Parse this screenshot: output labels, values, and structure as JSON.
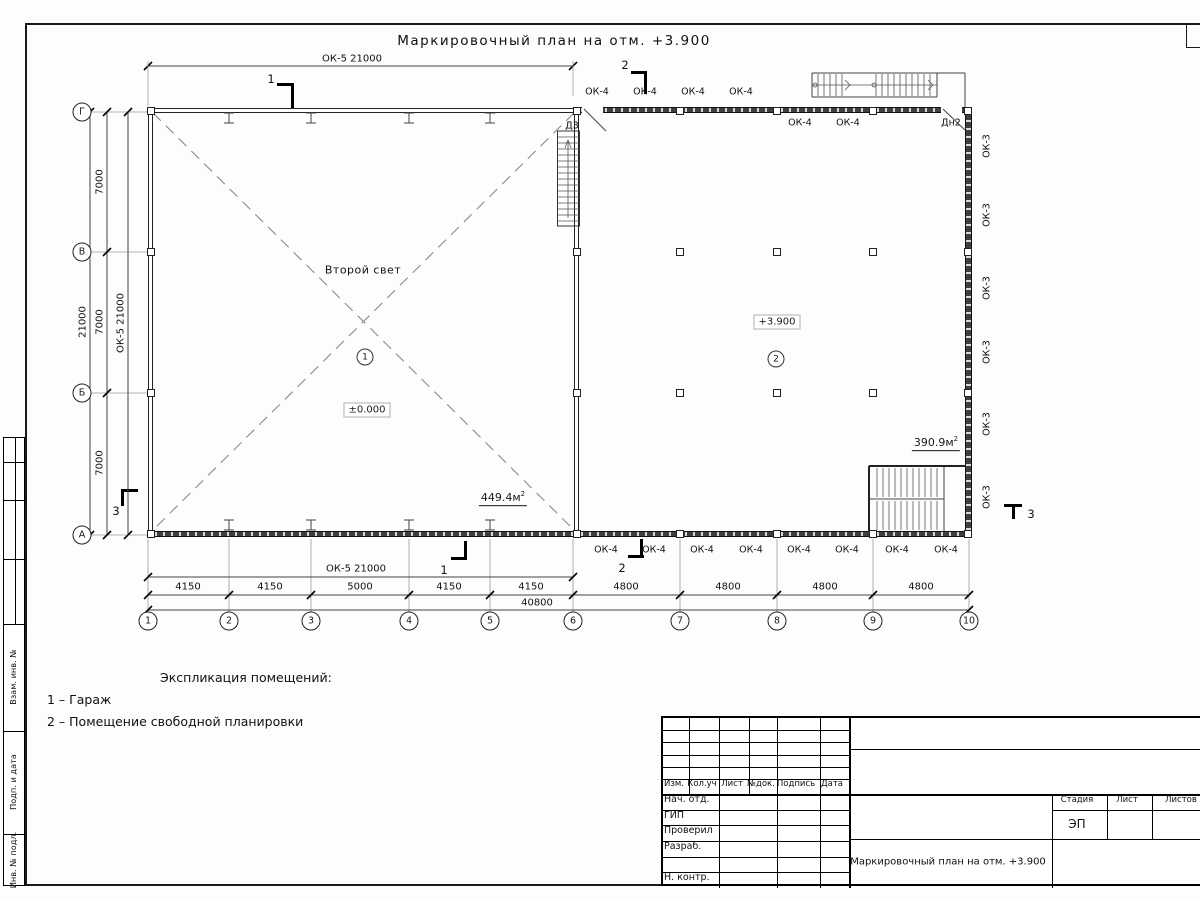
{
  "sheet": {
    "title": "Маркировочный план на отм. +3.900"
  },
  "plan": {
    "marks": {
      "ok4": "ОК-4",
      "ok3": "ОК-3",
      "door_d3": "Д3",
      "door_dn2": "Дн2"
    },
    "rooms": [
      {
        "number": "1",
        "label": "Второй свет",
        "level": "±0.000",
        "area_value": "449.4м",
        "area_sup": "2"
      },
      {
        "number": "2",
        "level": "+3.900",
        "area_value": "390.9м",
        "area_sup": "2"
      }
    ],
    "placements": {
      "ok4_top_above": [
        {
          "x": 597,
          "y": 92
        },
        {
          "x": 645,
          "y": 92
        },
        {
          "x": 693,
          "y": 92
        },
        {
          "x": 741,
          "y": 92
        }
      ],
      "ok4_top_below": [
        {
          "x": 800,
          "y": 123
        },
        {
          "x": 848,
          "y": 123
        }
      ],
      "dn2": {
        "x": 951,
        "y": 123
      },
      "d3": {
        "x": 572,
        "y": 126
      },
      "ok4_bottom": [
        {
          "x": 606,
          "y": 550
        },
        {
          "x": 654,
          "y": 550
        },
        {
          "x": 702,
          "y": 550
        },
        {
          "x": 751,
          "y": 550
        },
        {
          "x": 799,
          "y": 550
        },
        {
          "x": 847,
          "y": 550
        },
        {
          "x": 897,
          "y": 550
        },
        {
          "x": 946,
          "y": 550
        }
      ],
      "ok3_right": [
        {
          "x": 987,
          "y": 146
        },
        {
          "x": 987,
          "y": 215
        },
        {
          "x": 987,
          "y": 288
        },
        {
          "x": 987,
          "y": 352
        },
        {
          "x": 987,
          "y": 424
        },
        {
          "x": 987,
          "y": 497
        }
      ]
    }
  },
  "axes": {
    "letters": [
      {
        "label": "Г",
        "y": 112
      },
      {
        "label": "В",
        "y": 252
      },
      {
        "label": "Б",
        "y": 393
      },
      {
        "label": "А",
        "y": 535
      }
    ],
    "numbers": [
      {
        "label": "1",
        "x": 148
      },
      {
        "label": "2",
        "x": 229
      },
      {
        "label": "3",
        "x": 311
      },
      {
        "label": "4",
        "x": 409
      },
      {
        "label": "5",
        "x": 490
      },
      {
        "label": "6",
        "x": 573
      },
      {
        "label": "7",
        "x": 680
      },
      {
        "label": "8",
        "x": 777
      },
      {
        "label": "9",
        "x": 873
      },
      {
        "label": "10",
        "x": 969
      }
    ]
  },
  "dimensions": {
    "top_window": "ОК-5 21000",
    "bottom_window": "ОК-5 21000",
    "left_window": "ОК-5 21000",
    "left_segments": [
      {
        "text": "7000",
        "y": 182
      },
      {
        "text": "7000",
        "y": 322
      },
      {
        "text": "7000",
        "y": 463
      }
    ],
    "left_total": "21000",
    "bottom_segments": [
      {
        "text": "4150",
        "x": 188
      },
      {
        "text": "4150",
        "x": 270
      },
      {
        "text": "5000",
        "x": 360
      },
      {
        "text": "4150",
        "x": 449
      },
      {
        "text": "4150",
        "x": 531
      },
      {
        "text": "4800",
        "x": 626
      },
      {
        "text": "4800",
        "x": 728
      },
      {
        "text": "4800",
        "x": 825
      },
      {
        "text": "4800",
        "x": 921
      }
    ],
    "bottom_total": "40800"
  },
  "sections": {
    "s1": "1",
    "s2": "2",
    "s3": "3"
  },
  "legend": {
    "header": "Экспликация помещений:",
    "items": [
      "1 – Гараж",
      "2 – Помещение свободной планировки"
    ]
  },
  "titleblock": {
    "rev_headers": [
      "Изм.",
      "Кол.уч",
      "Лист",
      "№док.",
      "Подпись",
      "Дата"
    ],
    "sign_rows": [
      "Нач. отд.",
      "ГИП",
      "Проверил",
      "Разраб.",
      "",
      "Н. контр."
    ],
    "stage_headers": [
      "Стадия",
      "Лист",
      "Листов"
    ],
    "stage_value": "ЭП",
    "doc_title": "Маркировочный план на отм. +3.900"
  },
  "side_strip": {
    "labels": [
      "Взам. инв. №",
      "Подп. и дата",
      "Инв. № подл."
    ]
  }
}
